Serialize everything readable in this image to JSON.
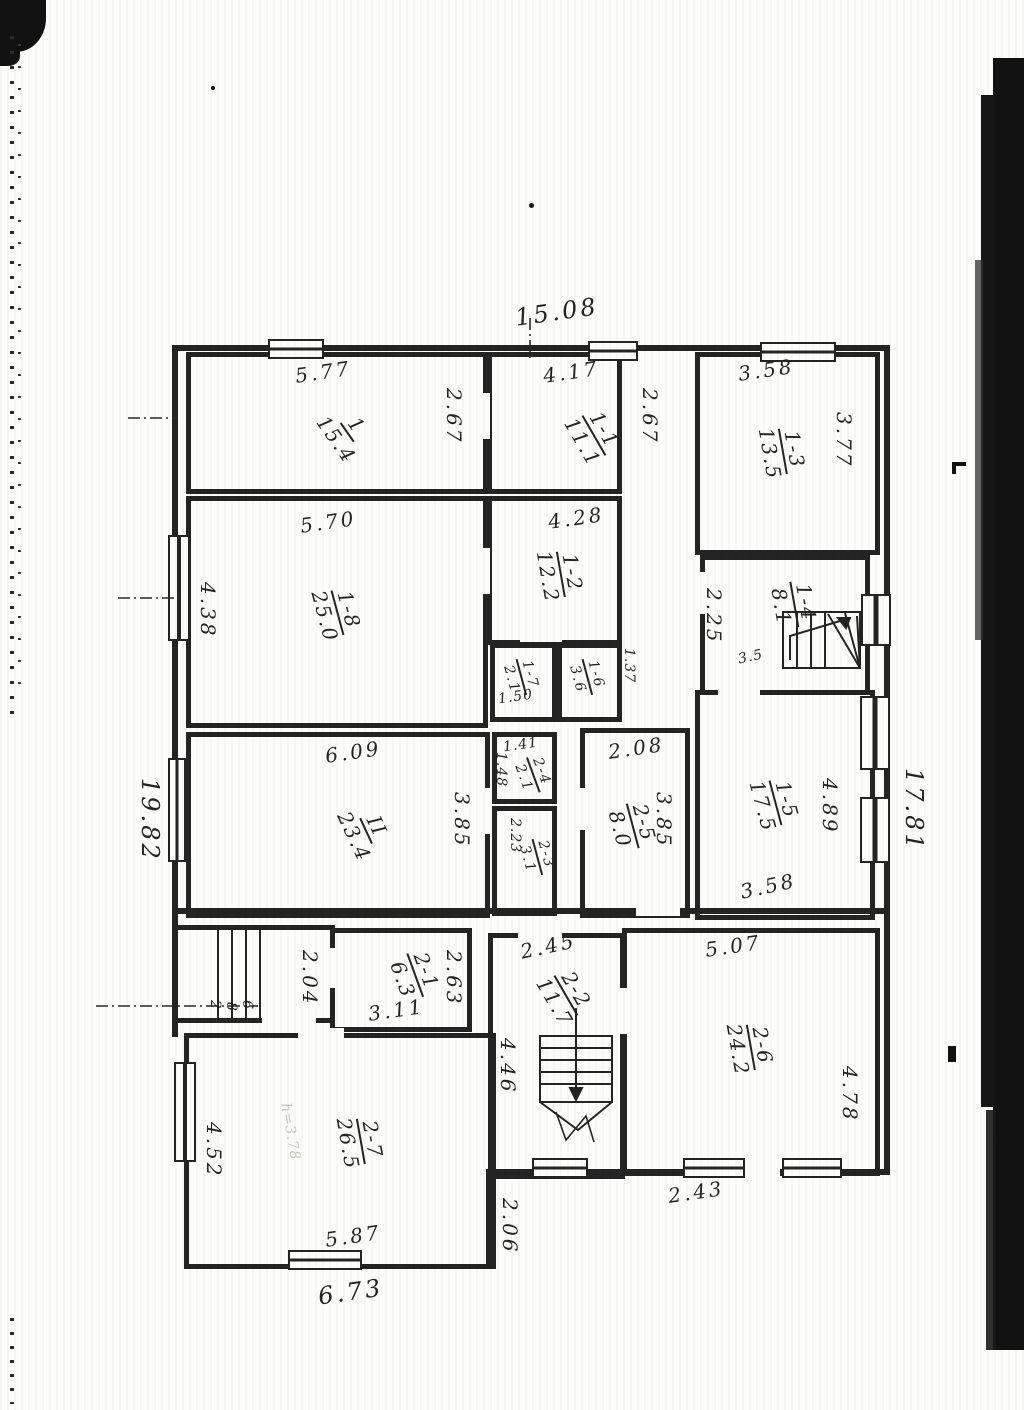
{
  "plan": {
    "outer": {
      "top": "15.08",
      "left": "19.82",
      "right": "17.81",
      "bottom_mid": "2.06"
    },
    "rooms": [
      {
        "code": "1",
        "area": "15.4",
        "top": "5.77",
        "side": "2.67"
      },
      {
        "code": "1-1",
        "area": "11.1",
        "top": "4.17",
        "side": "2.67"
      },
      {
        "code": "1-3",
        "area": "13.5",
        "top": "3.58",
        "side": "3.77"
      },
      {
        "code": "1-8",
        "area": "25.0",
        "top": "5.70",
        "side": "4.38"
      },
      {
        "code": "1-2",
        "area": "12.2",
        "top": "4.28"
      },
      {
        "code": "1-7",
        "area": "2.1",
        "bottom": "1.50"
      },
      {
        "code": "1-6",
        "area": "3.6",
        "side": "1.37"
      },
      {
        "code": "1-4",
        "area": "8.1",
        "side": "2.25",
        "bottom": "3.5"
      },
      {
        "code": "II",
        "area": "23.4",
        "top": "6.09",
        "side": "3.85"
      },
      {
        "code": "2-4",
        "area": "2.1",
        "top": "1.41",
        "side": "1.48"
      },
      {
        "code": "2-3",
        "area": "3.1",
        "side": "2.23"
      },
      {
        "code": "2-5",
        "area": "8.0",
        "top": "2.08",
        "side": "3.85"
      },
      {
        "code": "1-5",
        "area": "17.5",
        "side": "4.89",
        "bottom": "3.58"
      },
      {
        "code": "2-1",
        "area": "6.3",
        "bottom": "3.11",
        "side": "2.63",
        "left": "2.04"
      },
      {
        "code": "2-2",
        "area": "11.7",
        "top": "2.45",
        "side": "4.46"
      },
      {
        "code": "2-6",
        "area": "24.2",
        "top": "5.07",
        "side": "4.78",
        "bottom": "2.43"
      },
      {
        "code": "2-7",
        "area": "26.5",
        "side": "4.52",
        "bottom": "5.87",
        "outer_bottom": "6.73",
        "note": "h=3.78"
      }
    ],
    "porch_steps": [
      "2",
      "8",
      "6"
    ]
  }
}
